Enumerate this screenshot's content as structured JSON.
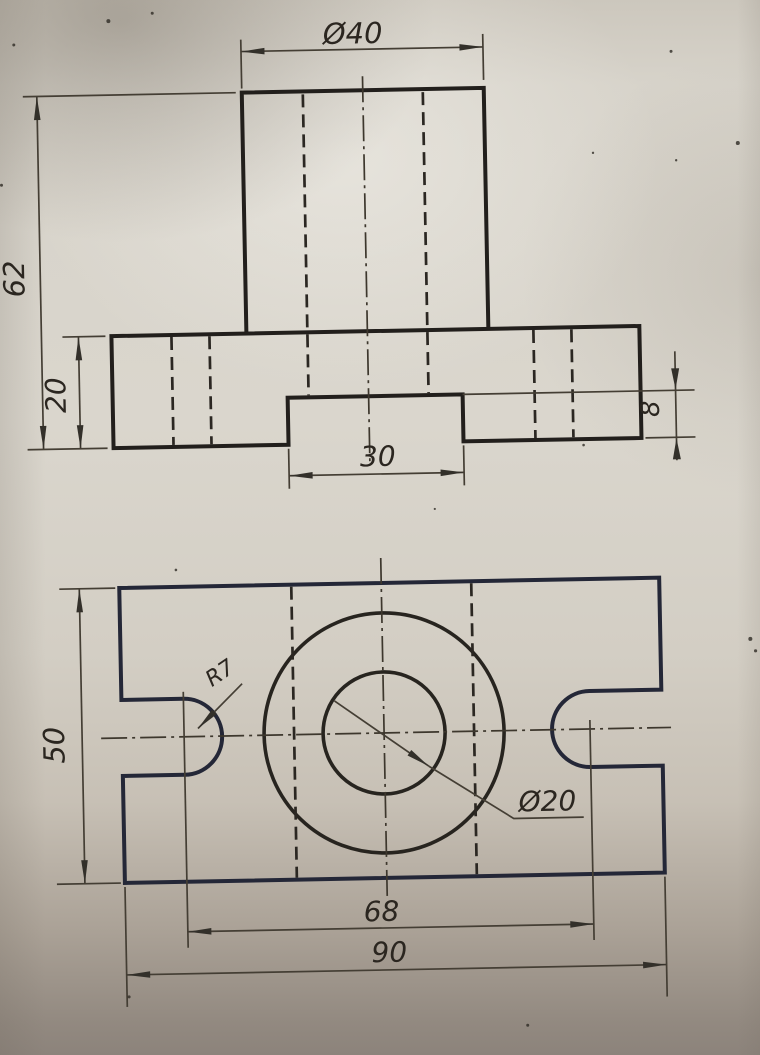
{
  "document": {
    "kind": "Scanned engineering drawing, two-view orthographic projection",
    "part": "Flanged block: cylindrical boss on rectangular base plate with central through hole, two open end slots and a bottom groove",
    "paper_color": "#d7d3ca",
    "ink_color": "#26231f",
    "line_styles": [
      "solid outline",
      "dashed hidden line",
      "dash-dot center line"
    ]
  },
  "front_view": {
    "name": "front view",
    "dims": {
      "dia40": {
        "label": "Ø40",
        "value": 40,
        "feature": "boss outside diameter"
      },
      "h62": {
        "label": "62",
        "value": 62,
        "feature": "overall height"
      },
      "h20": {
        "label": "20",
        "value": 20,
        "feature": "base plate thickness"
      },
      "w30": {
        "label": "30",
        "value": 30,
        "feature": "bottom groove width"
      },
      "h8": {
        "label": "8",
        "value": 8,
        "feature": "bottom groove depth"
      }
    }
  },
  "top_view": {
    "name": "top view",
    "dims": {
      "d50": {
        "label": "50",
        "value": 50,
        "feature": "plate depth"
      },
      "w90": {
        "label": "90",
        "value": 90,
        "feature": "plate overall width"
      },
      "w68": {
        "label": "68",
        "value": 68,
        "feature": "distance between slot end centers"
      },
      "r7": {
        "label": "R7",
        "value": 7,
        "feature": "slot end radius"
      },
      "dia20": {
        "label": "Ø20",
        "value": 20,
        "feature": "through hole diameter"
      }
    }
  }
}
